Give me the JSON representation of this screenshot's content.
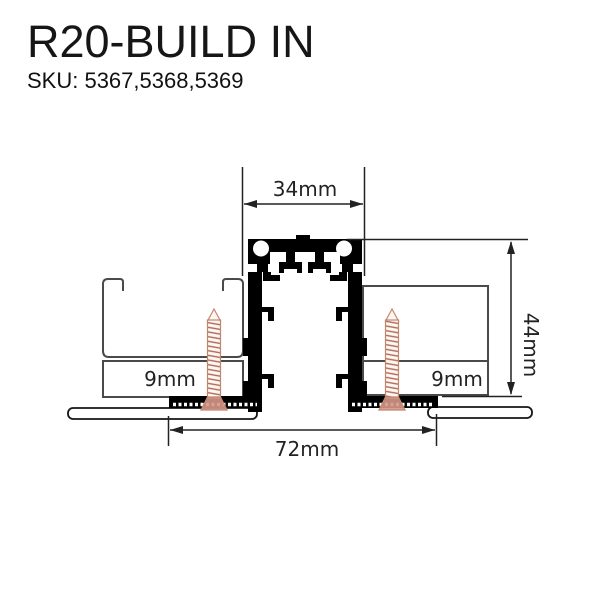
{
  "header": {
    "title": "R20-BUILD IN",
    "sku": "SKU: 5367,5368,5369"
  },
  "diagram": {
    "type": "installation cross-section of recessed magnetic track profile",
    "dimensions": {
      "top_width": "34mm",
      "height": "44mm",
      "bottom_width": "72mm",
      "left_board_thickness": "9mm",
      "right_board_thickness": "9mm"
    },
    "colors": {
      "background": "#ffffff",
      "profile": "#000000",
      "dimension_line": "#222222",
      "hardware_outline": "#4a4a4a",
      "board_fill": "#ffffff",
      "screw_outline": "#c08770",
      "screw_thread": "#b06a55",
      "screw_head": "#d59787"
    }
  }
}
